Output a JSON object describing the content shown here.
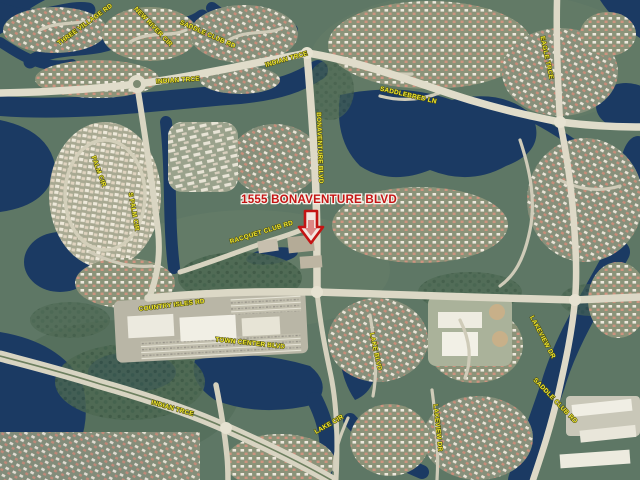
{
  "map": {
    "annotation": {
      "label": "1555 BONAVENTURE BLVD",
      "color": "#c41414",
      "marker": "down-arrow-icon"
    },
    "street_labels": [
      {
        "t": "INDIAN TRCE",
        "x": 178,
        "y": 82,
        "r": -4
      },
      {
        "t": "INDIAN TRCE",
        "x": 287,
        "y": 61,
        "r": -16
      },
      {
        "t": "NEW RIVER CIR",
        "x": 152,
        "y": 28,
        "r": 46
      },
      {
        "t": "THREE VILLAGE RD",
        "x": 86,
        "y": 26,
        "r": -36
      },
      {
        "t": "SADDLE CLUB RD",
        "x": 207,
        "y": 36,
        "r": 24
      },
      {
        "t": "BONAVENTURE BLVD",
        "x": 318,
        "y": 148,
        "r": 88
      },
      {
        "t": "RACQUET CLUB RD",
        "x": 262,
        "y": 234,
        "r": -17
      },
      {
        "t": "PALM CIR",
        "x": 97,
        "y": 172,
        "r": 70
      },
      {
        "t": "S PALM CIR",
        "x": 132,
        "y": 212,
        "r": 80
      },
      {
        "t": "EAGLE TRCE",
        "x": 545,
        "y": 58,
        "r": 78
      },
      {
        "t": "SADDLEBRED LN",
        "x": 408,
        "y": 97,
        "r": 13
      },
      {
        "t": "COUNTRY ISLES RD",
        "x": 172,
        "y": 307,
        "r": -7
      },
      {
        "t": "TOWN CENTER BLVD",
        "x": 250,
        "y": 345,
        "r": 6
      },
      {
        "t": "LAKEVIEW DR",
        "x": 541,
        "y": 338,
        "r": 62
      },
      {
        "t": "LAKEVIEW DR",
        "x": 436,
        "y": 428,
        "r": 84
      },
      {
        "t": "INDIAN TRCE",
        "x": 172,
        "y": 410,
        "r": 16
      },
      {
        "t": "SADDLE CLUB RD",
        "x": 554,
        "y": 402,
        "r": 46
      },
      {
        "t": "LAKE BLVD",
        "x": 374,
        "y": 352,
        "r": 78
      },
      {
        "t": "LAKE CIR",
        "x": 330,
        "y": 426,
        "r": -30
      }
    ],
    "palette": {
      "water": "#1b3a63",
      "land": "#5e7765",
      "road": "#dcd8c6",
      "label_yellow": "#f2ea2e",
      "annotation_red": "#c41414"
    }
  }
}
